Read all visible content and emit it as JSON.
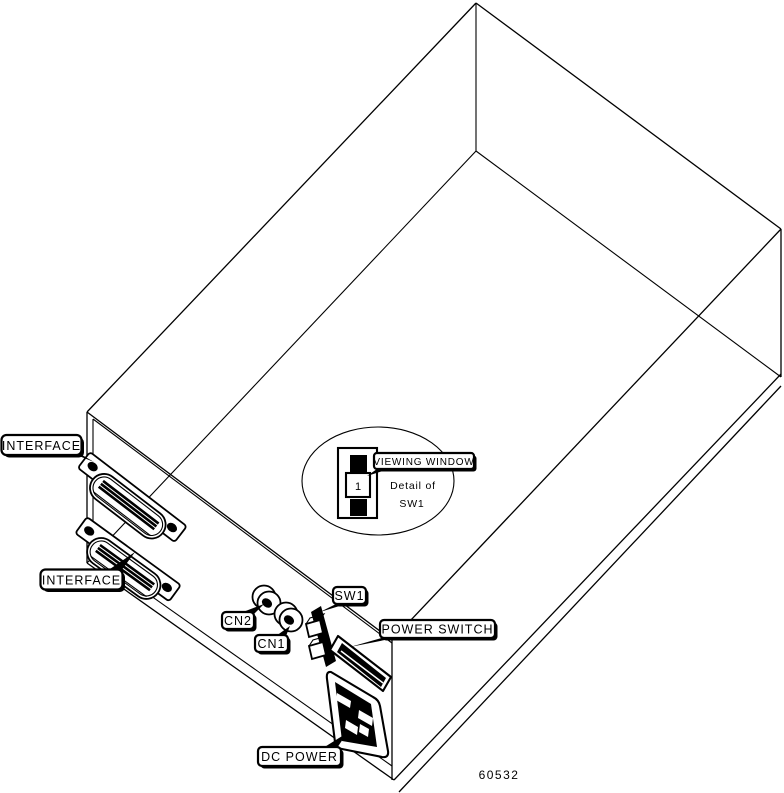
{
  "figure": {
    "figure_number": "60532",
    "labels": {
      "interface_top": "INTERFACE",
      "interface_bottom": "INTERFACE",
      "cn2": "CN2",
      "cn1": "CN1",
      "sw1": "SW1",
      "power_switch": "POWER SWITCH",
      "dc_power": "DC POWER",
      "viewing_window": "VIEWING WINDOW"
    },
    "detail": {
      "caption_line1": "Detail of",
      "caption_line2": "SW1",
      "switch_digit": "1"
    },
    "colors": {
      "line": "#000000",
      "background": "#ffffff"
    }
  }
}
